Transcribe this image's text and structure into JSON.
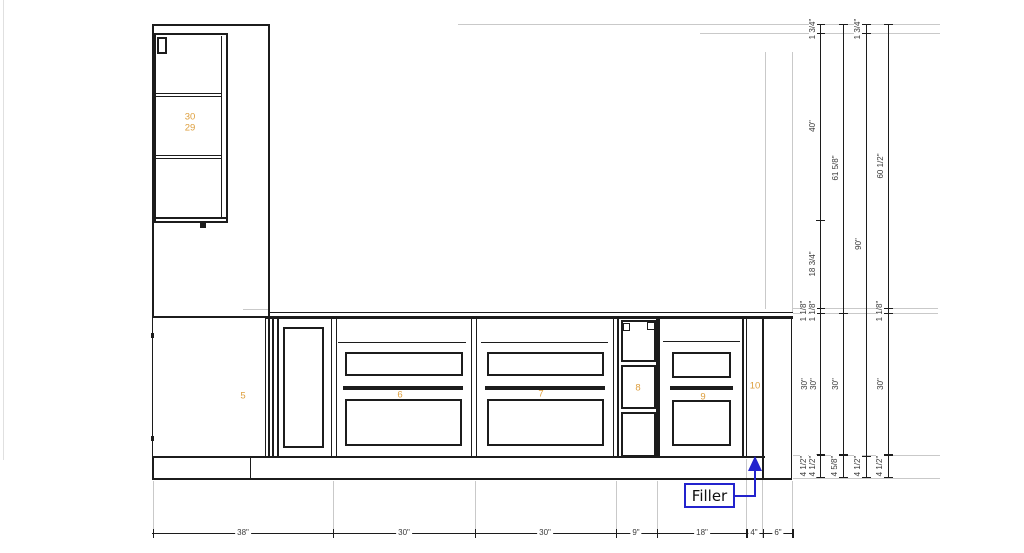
{
  "cabinet_numbers": {
    "tall_top": "30",
    "tall_bottom": "29",
    "blind_base": "5",
    "drawer_base_left": "6",
    "drawer_base_center": "7",
    "narrow_base": "8",
    "drawer_base_right": "9",
    "filler_panel": "10"
  },
  "callout": {
    "filler": "Filler"
  },
  "bottom_dimensions": [
    "38\"",
    "30\"",
    "30\"",
    "9\"",
    "18\"",
    "4\"",
    "6\""
  ],
  "right_dimensions": {
    "chain1": [
      "1 3/4\"",
      "40\"",
      "18 3/4\"",
      "1 1/8\"",
      "1 1/8\"",
      "30\"",
      "30\"",
      "4 1/2\"",
      "4 1/2\""
    ],
    "chain2": [
      "61 5/8\"",
      "30\"",
      "4 5/8\""
    ],
    "chain3": [
      "1 3/4\"",
      "90\"",
      "4 1/2\""
    ],
    "chain4": [
      "60 1/2\"",
      "1 1/8\"",
      "30\"",
      "4 1/2\""
    ]
  },
  "colors": {
    "drawing_line": "#1c1c1c",
    "extension_line": "#c9c9c9",
    "cabinet_number": "#dd9e3c",
    "callout_blue": "#2323cd",
    "dimension_text": "#3a3a3a"
  }
}
